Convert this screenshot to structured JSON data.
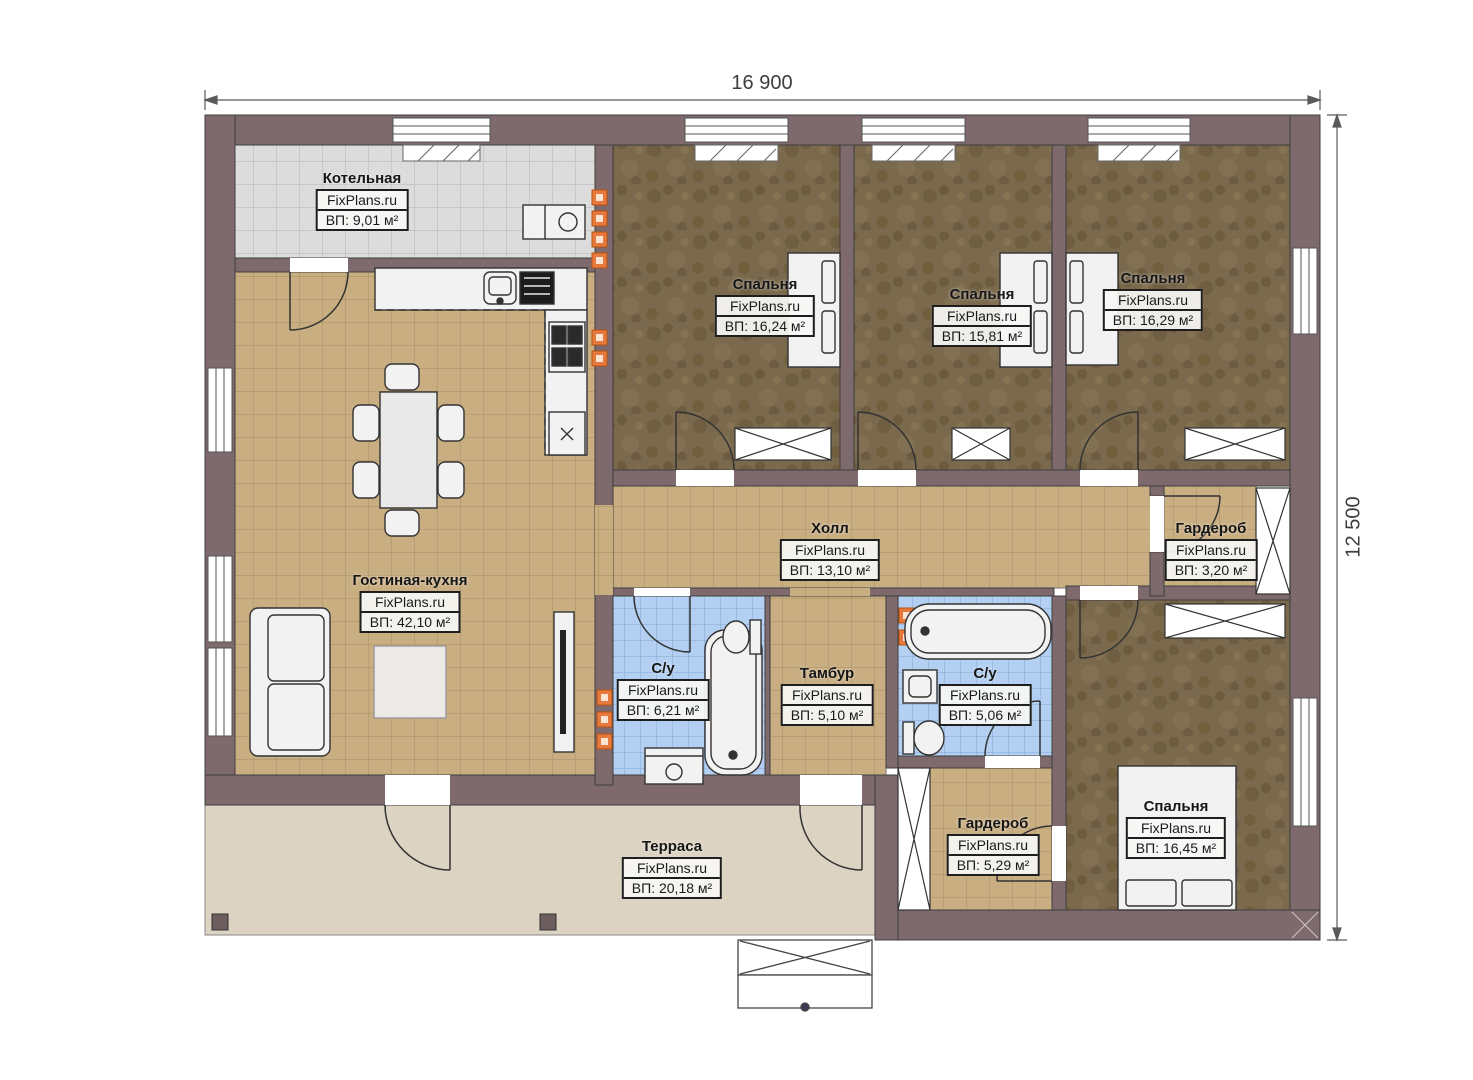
{
  "plan": {
    "type": "floor-plan",
    "brand_watermark": "FixPlans.ru",
    "dimensions": {
      "width": "16 900",
      "height": "12 500"
    }
  },
  "rooms": [
    {
      "name": "Котельная",
      "brand": "FixPlans.ru",
      "area": "ВП: 9,01 м²"
    },
    {
      "name": "Спальня",
      "brand": "FixPlans.ru",
      "area": "ВП: 16,24 м²"
    },
    {
      "name": "Спальня",
      "brand": "FixPlans.ru",
      "area": "ВП: 15,81 м²"
    },
    {
      "name": "Спальня",
      "brand": "FixPlans.ru",
      "area": "ВП: 16,29 м²"
    },
    {
      "name": "Холл",
      "brand": "FixPlans.ru",
      "area": "ВП: 13,10 м²"
    },
    {
      "name": "Гардероб",
      "brand": "FixPlans.ru",
      "area": "ВП: 3,20 м²"
    },
    {
      "name": "Гостиная-кухня",
      "brand": "FixPlans.ru",
      "area": "ВП: 42,10 м²"
    },
    {
      "name": "С/у",
      "brand": "FixPlans.ru",
      "area": "ВП: 6,21 м²"
    },
    {
      "name": "Тамбур",
      "brand": "FixPlans.ru",
      "area": "ВП: 5,10 м²"
    },
    {
      "name": "С/у",
      "brand": "FixPlans.ru",
      "area": "ВП: 5,06 м²"
    },
    {
      "name": "Гардероб",
      "brand": "FixPlans.ru",
      "area": "ВП: 5,29 м²"
    },
    {
      "name": "Спальня",
      "brand": "FixPlans.ru",
      "area": "ВП: 16,45 м²"
    },
    {
      "name": "Терраса",
      "brand": "FixPlans.ru",
      "area": "ВП: 20,18 м²"
    }
  ],
  "colors": {
    "wall": "#7e696c",
    "floor_tan_tile": "#c9ae82",
    "floor_gray_tile": "#dcdcdc",
    "floor_blue_tile": "#b3d0f2",
    "floor_brown_carpet": "#7a694c",
    "terrace": "#ddd3c2",
    "radiator_orange": "#e8793e"
  }
}
